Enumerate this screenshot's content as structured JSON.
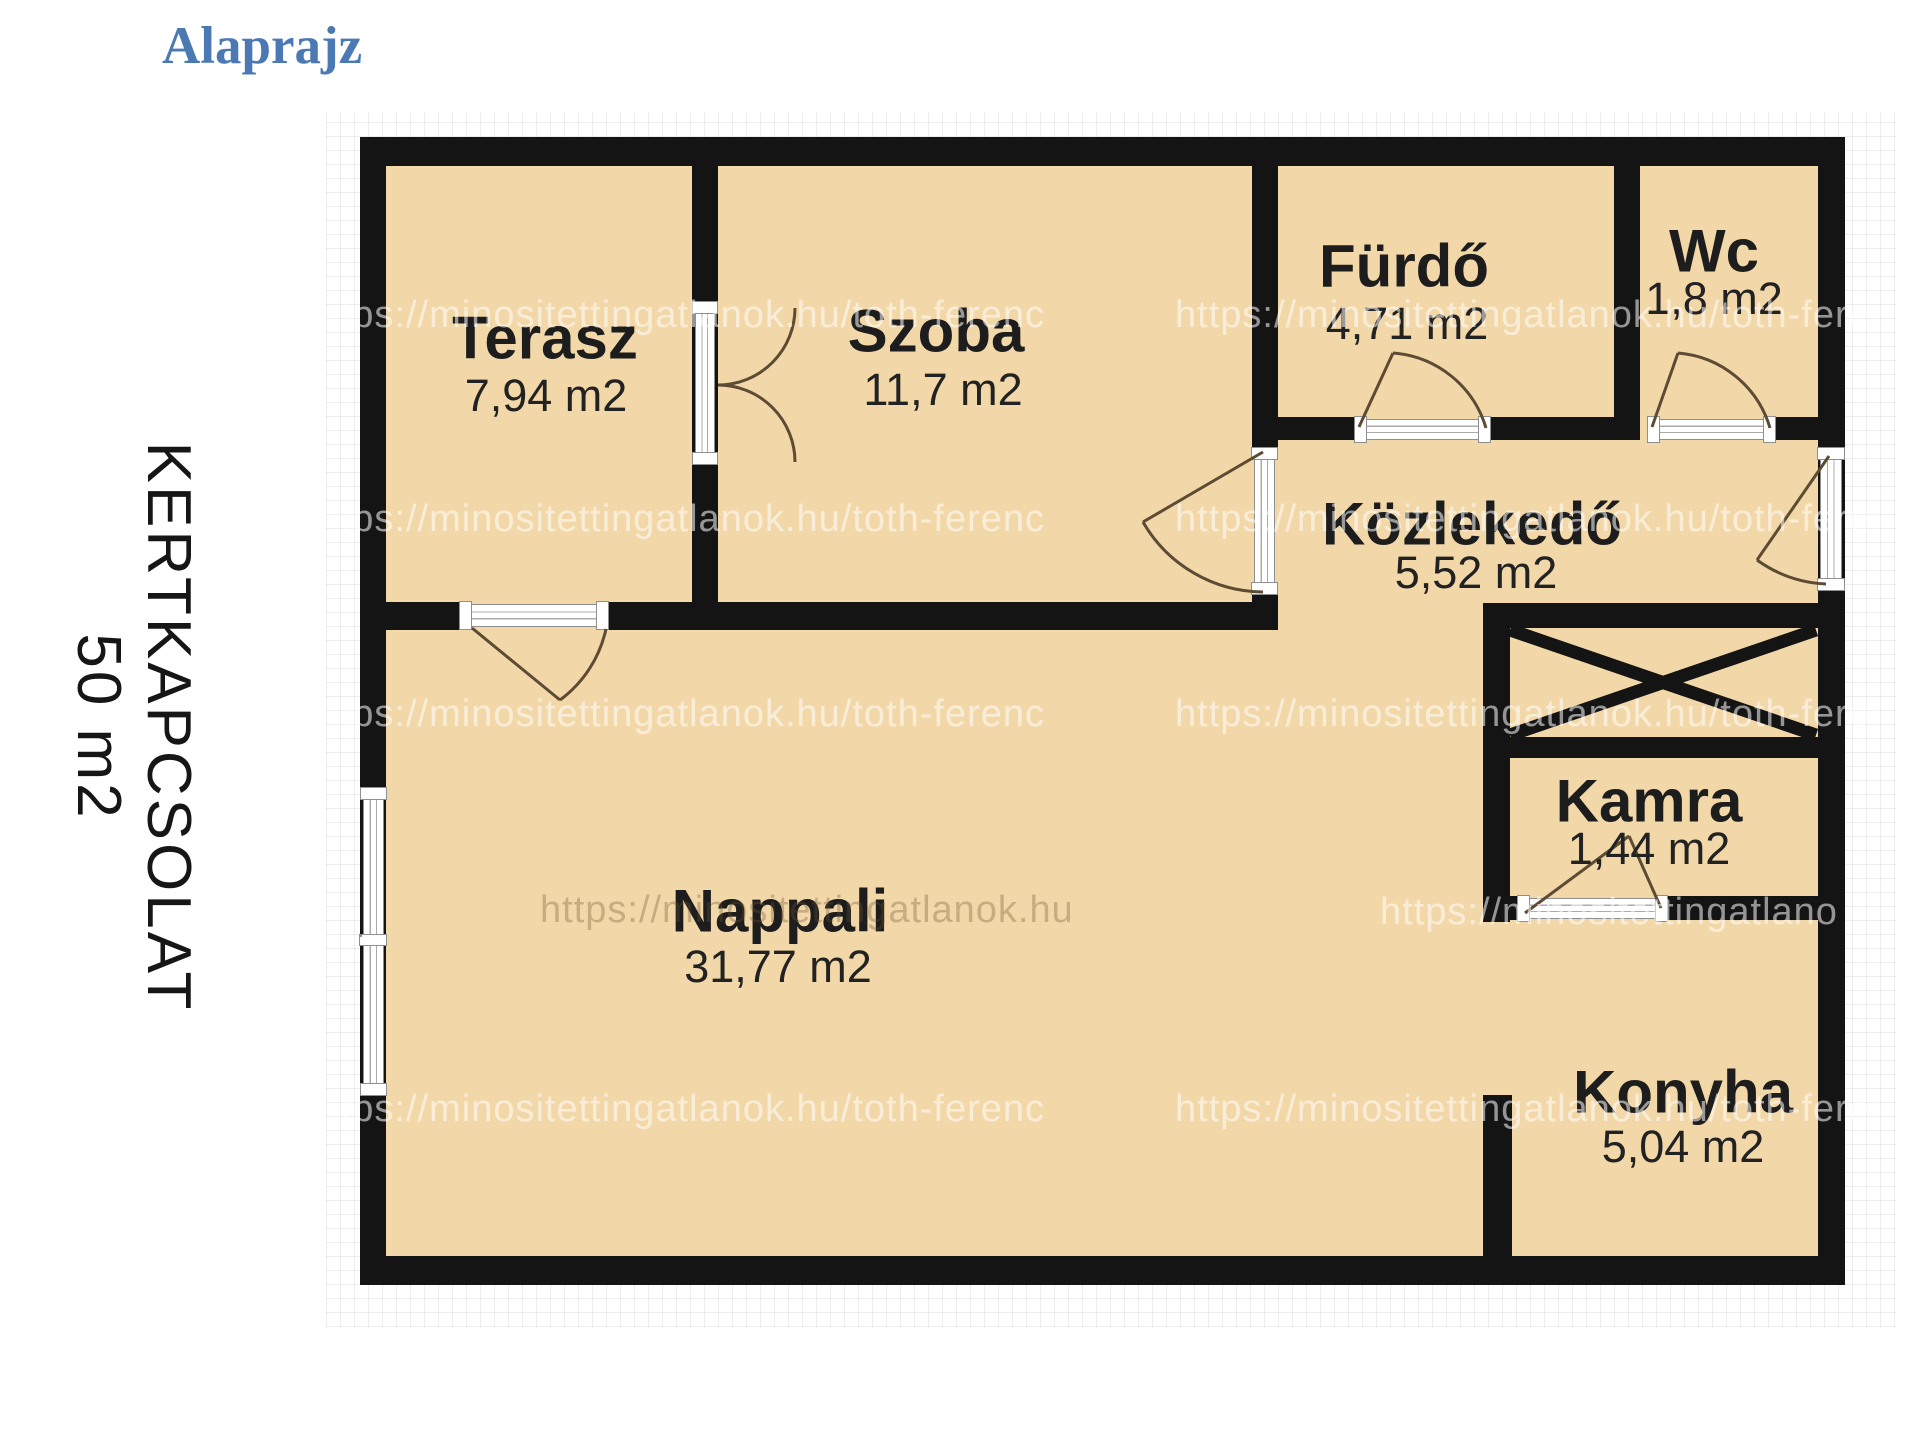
{
  "page": {
    "title": "Alaprajz"
  },
  "side_note": {
    "line1": "KERTKAPCSOLAT",
    "line2": "50 m2"
  },
  "watermark": {
    "text": "https://minositettingatlanok.hu/toth-ferenc"
  },
  "rooms": {
    "terasz": {
      "name": "Terasz",
      "area": "7,94 m2"
    },
    "szoba": {
      "name": "Szoba",
      "area": "11,7 m2"
    },
    "furdo": {
      "name": "Fürdő",
      "area": "4,71 m2"
    },
    "wc": {
      "name": "Wc",
      "area": "1,8 m2"
    },
    "kozlekedo": {
      "name": "Közlekedő",
      "area": "5,52 m2"
    },
    "kamra": {
      "name": "Kamra",
      "area": "1,44 m2"
    },
    "nappali": {
      "name": "Nappali",
      "area": "31,77 m2"
    },
    "konyha": {
      "name": "Konyha",
      "area": "5,04 m2"
    }
  },
  "colors": {
    "room_fill": "#f2d8a8",
    "wall": "#141414",
    "title_color": "#4b79b3",
    "door_arc": "#5d4b33",
    "label_color": "#1d1d1d",
    "window_frame": "#8f8f8f"
  }
}
